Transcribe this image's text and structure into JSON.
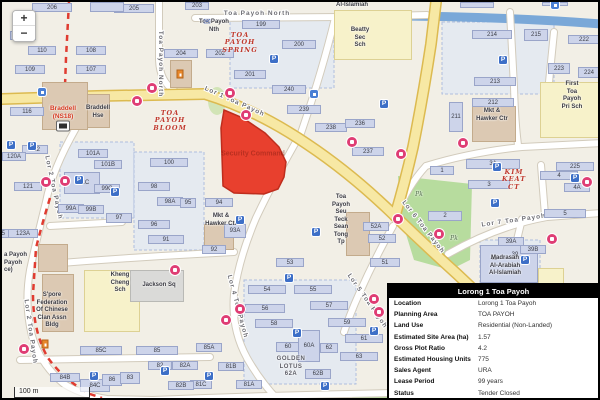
{
  "map": {
    "controls": {
      "zoom_in": "+",
      "zoom_out": "−",
      "scale_label": "100 m"
    },
    "parcel": {
      "label": "Security Command",
      "color": "#e8402e"
    },
    "streets": [
      {
        "t": "Toa Payoh North",
        "x": 255,
        "y": 13,
        "a": 0
      },
      {
        "t": "Toa Payoh North",
        "x": 157,
        "y": 62,
        "a": 90
      },
      {
        "t": "Lor 1 Toa Payoh",
        "x": 232,
        "y": 101,
        "a": 24
      },
      {
        "t": "Lor 2 Toa Payoh",
        "x": 50,
        "y": 186,
        "a": 78
      },
      {
        "t": "Lor 2 Toa Payoh",
        "x": 27,
        "y": 330,
        "a": 82
      },
      {
        "t": "Lor 4 Toa Payoh",
        "x": 234,
        "y": 305,
        "a": 75
      },
      {
        "t": "Lor 5 Toa Payoh",
        "x": 364,
        "y": 300,
        "a": 55
      },
      {
        "t": "Lor 6 Toa Payoh",
        "x": 420,
        "y": 226,
        "a": 52
      },
      {
        "t": "Lor 7 Toa Payoh",
        "x": 512,
        "y": 220,
        "a": -8
      }
    ],
    "estate_labels": [
      {
        "t": "TOA\nPAYOH\nSPRING",
        "x": 238,
        "y": 30
      },
      {
        "t": "TOA\nPAYOH\nBLOOM",
        "x": 168,
        "y": 108
      },
      {
        "t": "KIM\nKEAT\nCT",
        "x": 512,
        "y": 167
      }
    ],
    "poi_labels": [
      {
        "t": "Braddell\nHse",
        "x": 96,
        "y": 103
      },
      {
        "t": "Braddell\n(NS18)",
        "x": 61,
        "y": 103,
        "cls": "mrt-name"
      },
      {
        "t": "Beatty\nSec\nSch",
        "x": 358,
        "y": 25
      },
      {
        "t": "First\nToa\nPayoh\nPri Sch",
        "x": 570,
        "y": 79
      },
      {
        "t": "Kheng\nCheng\nSch",
        "x": 118,
        "y": 270
      },
      {
        "t": "Jackson Sq",
        "x": 157,
        "y": 280
      },
      {
        "t": "S'pore\nFederation\nOf Chinese\nClan Assn\nBldg",
        "x": 50,
        "y": 290
      },
      {
        "t": "Mkt &\nHawker Ctr",
        "x": 219,
        "y": 211
      },
      {
        "t": "Mkt &\nHawker Ctr",
        "x": 490,
        "y": 106
      },
      {
        "t": "Toa\nPayoh\nSeu\nTeck\nSean\nTong\nTp",
        "x": 339,
        "y": 192
      },
      {
        "t": "Madrasah\nAl-Arabiah\nAl-Islamiah",
        "x": 503,
        "y": 253
      },
      {
        "t": "Al-Islamiah",
        "x": 350,
        "y": 0
      },
      {
        "t": "Toa Payoh\nNth",
        "x": 212,
        "y": 17
      },
      {
        "t": "a Payoh\nPayoh\nce)",
        "x": 2,
        "y": 250,
        "cls": "left"
      },
      {
        "t": "GOLDEN\nLOTUS\n62A",
        "x": 289,
        "y": 354,
        "cls": "gray-caps"
      },
      {
        "t": "Pk",
        "x": 417,
        "y": 189,
        "cls": "pk"
      },
      {
        "t": "Pk",
        "x": 452,
        "y": 233,
        "cls": "pk"
      }
    ],
    "buildings": [
      {
        "n": "206",
        "x": 30,
        "y": 1,
        "w": 40,
        "h": 9
      },
      {
        "n": "205",
        "x": 112,
        "y": 2,
        "w": 40,
        "h": 9
      },
      {
        "n": "203",
        "x": 183,
        "y": 0,
        "w": 24,
        "h": 8
      },
      {
        "n": "110A",
        "x": 8,
        "y": 29,
        "w": 26,
        "h": 9
      },
      {
        "n": "110",
        "x": 26,
        "y": 44,
        "w": 28,
        "h": 9
      },
      {
        "n": "108",
        "x": 74,
        "y": 44,
        "w": 30,
        "h": 9
      },
      {
        "n": "109",
        "x": 13,
        "y": 63,
        "w": 30,
        "h": 9
      },
      {
        "n": "107",
        "x": 74,
        "y": 63,
        "w": 30,
        "h": 9
      },
      {
        "n": "204",
        "x": 162,
        "y": 47,
        "w": 34,
        "h": 9
      },
      {
        "n": "116",
        "x": 8,
        "y": 105,
        "w": 34,
        "h": 9
      },
      {
        "n": "122",
        "x": 20,
        "y": 143,
        "w": 26,
        "h": 9
      },
      {
        "n": "120A",
        "x": 0,
        "y": 150,
        "w": 24,
        "h": 9
      },
      {
        "n": "121",
        "x": 12,
        "y": 180,
        "w": 28,
        "h": 9
      },
      {
        "n": "123A",
        "x": 6,
        "y": 227,
        "w": 30,
        "h": 9
      },
      {
        "n": "125",
        "x": -11,
        "y": 227,
        "w": 18,
        "h": 9
      },
      {
        "n": "199",
        "x": 240,
        "y": 18,
        "w": 38,
        "h": 9
      },
      {
        "n": "202",
        "x": 204,
        "y": 47,
        "w": 28,
        "h": 9
      },
      {
        "n": "200",
        "x": 280,
        "y": 38,
        "w": 34,
        "h": 9
      },
      {
        "n": "201",
        "x": 232,
        "y": 68,
        "w": 32,
        "h": 9
      },
      {
        "n": "240",
        "x": 270,
        "y": 83,
        "w": 34,
        "h": 9
      },
      {
        "n": "239",
        "x": 285,
        "y": 103,
        "w": 34,
        "h": 9
      },
      {
        "n": "238",
        "x": 313,
        "y": 121,
        "w": 32,
        "h": 9
      },
      {
        "n": "236",
        "x": 343,
        "y": 117,
        "w": 30,
        "h": 9
      },
      {
        "n": "237",
        "x": 350,
        "y": 145,
        "w": 32,
        "h": 9
      },
      {
        "n": "214",
        "x": 470,
        "y": 28,
        "w": 40,
        "h": 9
      },
      {
        "n": "215",
        "x": 522,
        "y": 27,
        "w": 24,
        "h": 12
      },
      {
        "n": "222",
        "x": 566,
        "y": 33,
        "w": 32,
        "h": 9
      },
      {
        "n": "223",
        "x": 546,
        "y": 61,
        "w": 22,
        "h": 11
      },
      {
        "n": "224",
        "x": 576,
        "y": 65,
        "w": 22,
        "h": 11
      },
      {
        "n": "213",
        "x": 472,
        "y": 75,
        "w": 42,
        "h": 9
      },
      {
        "n": "212",
        "x": 470,
        "y": 96,
        "w": 42,
        "h": 9
      },
      {
        "n": "211",
        "x": 447,
        "y": 100,
        "w": 14,
        "h": 30
      },
      {
        "n": "225",
        "x": 554,
        "y": 160,
        "w": 38,
        "h": 9
      },
      {
        "n": "100",
        "x": 148,
        "y": 156,
        "w": 38,
        "h": 9
      },
      {
        "n": "98",
        "x": 136,
        "y": 180,
        "w": 32,
        "h": 9
      },
      {
        "n": "98A",
        "x": 155,
        "y": 195,
        "w": 26,
        "h": 9
      },
      {
        "n": "95",
        "x": 178,
        "y": 196,
        "w": 16,
        "h": 10
      },
      {
        "n": "96",
        "x": 136,
        "y": 218,
        "w": 32,
        "h": 9
      },
      {
        "n": "97",
        "x": 104,
        "y": 211,
        "w": 26,
        "h": 10
      },
      {
        "n": "91",
        "x": 146,
        "y": 233,
        "w": 36,
        "h": 9
      },
      {
        "n": "101A",
        "x": 76,
        "y": 147,
        "w": 30,
        "h": 9
      },
      {
        "n": "101B",
        "x": 92,
        "y": 158,
        "w": 28,
        "h": 9
      },
      {
        "n": "101C",
        "x": 62,
        "y": 170,
        "w": 36,
        "h": 22
      },
      {
        "n": "99C",
        "x": 92,
        "y": 182,
        "w": 26,
        "h": 9
      },
      {
        "n": "99A",
        "x": 56,
        "y": 202,
        "w": 26,
        "h": 9
      },
      {
        "n": "99B",
        "x": 76,
        "y": 203,
        "w": 26,
        "h": 9
      },
      {
        "n": "94",
        "x": 203,
        "y": 196,
        "w": 28,
        "h": 9
      },
      {
        "n": "93A",
        "x": 222,
        "y": 222,
        "w": 22,
        "h": 14
      },
      {
        "n": "92",
        "x": 200,
        "y": 243,
        "w": 24,
        "h": 9
      },
      {
        "n": "52A",
        "x": 361,
        "y": 220,
        "w": 26,
        "h": 9
      },
      {
        "n": "52",
        "x": 366,
        "y": 232,
        "w": 28,
        "h": 9
      },
      {
        "n": "51",
        "x": 368,
        "y": 256,
        "w": 30,
        "h": 9
      },
      {
        "n": "53",
        "x": 274,
        "y": 256,
        "w": 28,
        "h": 9
      },
      {
        "n": "1",
        "x": 428,
        "y": 164,
        "w": 24,
        "h": 9
      },
      {
        "n": "3A",
        "x": 464,
        "y": 157,
        "w": 54,
        "h": 10
      },
      {
        "n": "3",
        "x": 466,
        "y": 178,
        "w": 42,
        "h": 9
      },
      {
        "n": "2",
        "x": 426,
        "y": 209,
        "w": 34,
        "h": 10
      },
      {
        "n": "4",
        "x": 538,
        "y": 169,
        "w": 38,
        "h": 9
      },
      {
        "n": "4A",
        "x": 562,
        "y": 181,
        "w": 26,
        "h": 9
      },
      {
        "n": "5",
        "x": 542,
        "y": 207,
        "w": 42,
        "h": 9
      },
      {
        "n": "39A",
        "x": 496,
        "y": 235,
        "w": 26,
        "h": 9
      },
      {
        "n": "39B",
        "x": 518,
        "y": 243,
        "w": 26,
        "h": 9
      },
      {
        "n": "40",
        "x": 484,
        "y": 252,
        "w": 16,
        "h": 10,
        "bare": true
      },
      {
        "n": "39",
        "x": 505,
        "y": 248,
        "w": 16,
        "h": 10,
        "bare": true
      },
      {
        "n": "54",
        "x": 246,
        "y": 283,
        "w": 38,
        "h": 9
      },
      {
        "n": "55",
        "x": 292,
        "y": 283,
        "w": 38,
        "h": 9
      },
      {
        "n": "56",
        "x": 243,
        "y": 302,
        "w": 40,
        "h": 9
      },
      {
        "n": "57",
        "x": 308,
        "y": 299,
        "w": 38,
        "h": 9
      },
      {
        "n": "58",
        "x": 253,
        "y": 317,
        "w": 38,
        "h": 9
      },
      {
        "n": "59",
        "x": 326,
        "y": 316,
        "w": 38,
        "h": 9
      },
      {
        "n": "60",
        "x": 274,
        "y": 340,
        "w": 24,
        "h": 10
      },
      {
        "n": "60A",
        "x": 296,
        "y": 328,
        "w": 22,
        "h": 32
      },
      {
        "n": "62",
        "x": 318,
        "y": 341,
        "w": 18,
        "h": 10
      },
      {
        "n": "61",
        "x": 343,
        "y": 332,
        "w": 38,
        "h": 9
      },
      {
        "n": "63",
        "x": 338,
        "y": 350,
        "w": 38,
        "h": 9
      },
      {
        "n": "62B",
        "x": 303,
        "y": 367,
        "w": 26,
        "h": 10
      },
      {
        "n": "85A",
        "x": 194,
        "y": 341,
        "w": 26,
        "h": 9
      },
      {
        "n": "81B",
        "x": 216,
        "y": 360,
        "w": 26,
        "h": 9
      },
      {
        "n": "81A",
        "x": 234,
        "y": 378,
        "w": 26,
        "h": 9
      },
      {
        "n": "81C",
        "x": 188,
        "y": 378,
        "w": 22,
        "h": 9
      },
      {
        "n": "85C",
        "x": 78,
        "y": 344,
        "w": 42,
        "h": 9
      },
      {
        "n": "85",
        "x": 134,
        "y": 344,
        "w": 42,
        "h": 9
      },
      {
        "n": "84B",
        "x": 48,
        "y": 371,
        "w": 30,
        "h": 9
      },
      {
        "n": "84C",
        "x": 78,
        "y": 377,
        "w": 30,
        "h": 13
      },
      {
        "n": "86",
        "x": 100,
        "y": 372,
        "w": 20,
        "h": 12
      },
      {
        "n": "83",
        "x": 118,
        "y": 370,
        "w": 20,
        "h": 12
      },
      {
        "n": "82",
        "x": 146,
        "y": 359,
        "w": 24,
        "h": 9
      },
      {
        "n": "82A",
        "x": 170,
        "y": 359,
        "w": 26,
        "h": 9
      },
      {
        "n": "82B",
        "x": 166,
        "y": 379,
        "w": 26,
        "h": 9
      },
      {
        "n": "",
        "x": 458,
        "y": 0,
        "w": 34,
        "h": 6
      },
      {
        "n": "",
        "x": 540,
        "y": 0,
        "w": 26,
        "h": 4
      },
      {
        "n": "",
        "x": 88,
        "y": 0,
        "w": 34,
        "h": 10
      }
    ],
    "blocks": [
      {
        "k": "school",
        "x": 332,
        "y": 8,
        "w": 78,
        "h": 50
      },
      {
        "k": "school",
        "x": 538,
        "y": 80,
        "w": 62,
        "h": 56
      },
      {
        "k": "school",
        "x": 82,
        "y": 268,
        "w": 56,
        "h": 62
      },
      {
        "k": "school",
        "x": 536,
        "y": 266,
        "w": 26,
        "h": 18
      },
      {
        "k": "civic",
        "x": 36,
        "y": 242,
        "w": 30,
        "h": 28
      },
      {
        "k": "civic",
        "x": 40,
        "y": 272,
        "w": 32,
        "h": 58
      },
      {
        "k": "civic",
        "x": 82,
        "y": 92,
        "w": 26,
        "h": 34
      },
      {
        "k": "civic",
        "x": 40,
        "y": 80,
        "w": 46,
        "h": 48
      },
      {
        "k": "civic",
        "x": 202,
        "y": 222,
        "w": 30,
        "h": 26
      },
      {
        "k": "civic",
        "x": 344,
        "y": 210,
        "w": 24,
        "h": 44
      },
      {
        "k": "civic",
        "x": 470,
        "y": 104,
        "w": 44,
        "h": 36
      },
      {
        "k": "civic",
        "x": 168,
        "y": 58,
        "w": 22,
        "h": 28
      },
      {
        "k": "gray",
        "x": 128,
        "y": 268,
        "w": 54,
        "h": 32
      },
      {
        "k": "lav",
        "x": 478,
        "y": 243,
        "w": 58,
        "h": 38
      }
    ],
    "icons": {
      "bus": [
        [
          150,
          86
        ],
        [
          135,
          99
        ],
        [
          228,
          91
        ],
        [
          244,
          113
        ],
        [
          350,
          140
        ],
        [
          399,
          152
        ],
        [
          396,
          217
        ],
        [
          437,
          232
        ],
        [
          461,
          141
        ],
        [
          550,
          237
        ],
        [
          585,
          180
        ],
        [
          44,
          180
        ],
        [
          63,
          179
        ],
        [
          238,
          307
        ],
        [
          224,
          318
        ],
        [
          372,
          297
        ],
        [
          377,
          310
        ],
        [
          22,
          347
        ],
        [
          173,
          268
        ]
      ],
      "parking": [
        [
          30,
          144
        ],
        [
          9,
          143
        ],
        [
          77,
          178
        ],
        [
          113,
          190
        ],
        [
          272,
          57
        ],
        [
          382,
          102
        ],
        [
          501,
          58
        ],
        [
          238,
          218
        ],
        [
          314,
          230
        ],
        [
          495,
          165
        ],
        [
          573,
          176
        ],
        [
          493,
          201
        ],
        [
          287,
          276
        ],
        [
          295,
          331
        ],
        [
          207,
          374
        ],
        [
          372,
          329
        ],
        [
          323,
          384
        ],
        [
          523,
          258
        ],
        [
          92,
          374
        ],
        [
          163,
          369
        ]
      ],
      "info": [
        [
          27,
          22
        ],
        [
          40,
          90
        ],
        [
          312,
          92
        ],
        [
          553,
          3
        ]
      ],
      "orange": [
        [
          178,
          72
        ],
        [
          43,
          342
        ]
      ],
      "station": [
        61,
        124
      ],
      "post": [
        205,
        20
      ]
    }
  },
  "panel": {
    "title": "Lorong 1 Toa Payoh",
    "rows": [
      {
        "label": "Location",
        "value": "Lorong 1 Toa Payoh"
      },
      {
        "label": "Planning Area",
        "value": "TOA PAYOH"
      },
      {
        "label": "Land Use",
        "value": "Residential (Non-Landed)"
      },
      {
        "label": "Estimated Site Area (ha)",
        "value": "1.57"
      },
      {
        "label": "Gross Plot Ratio",
        "value": "4.2"
      },
      {
        "label": "Estimated Housing Units",
        "value": "775"
      },
      {
        "label": "Sales Agent",
        "value": "URA"
      },
      {
        "label": "Lease Period",
        "value": "99 years"
      },
      {
        "label": "Status",
        "value": "Tender Closed"
      }
    ]
  }
}
